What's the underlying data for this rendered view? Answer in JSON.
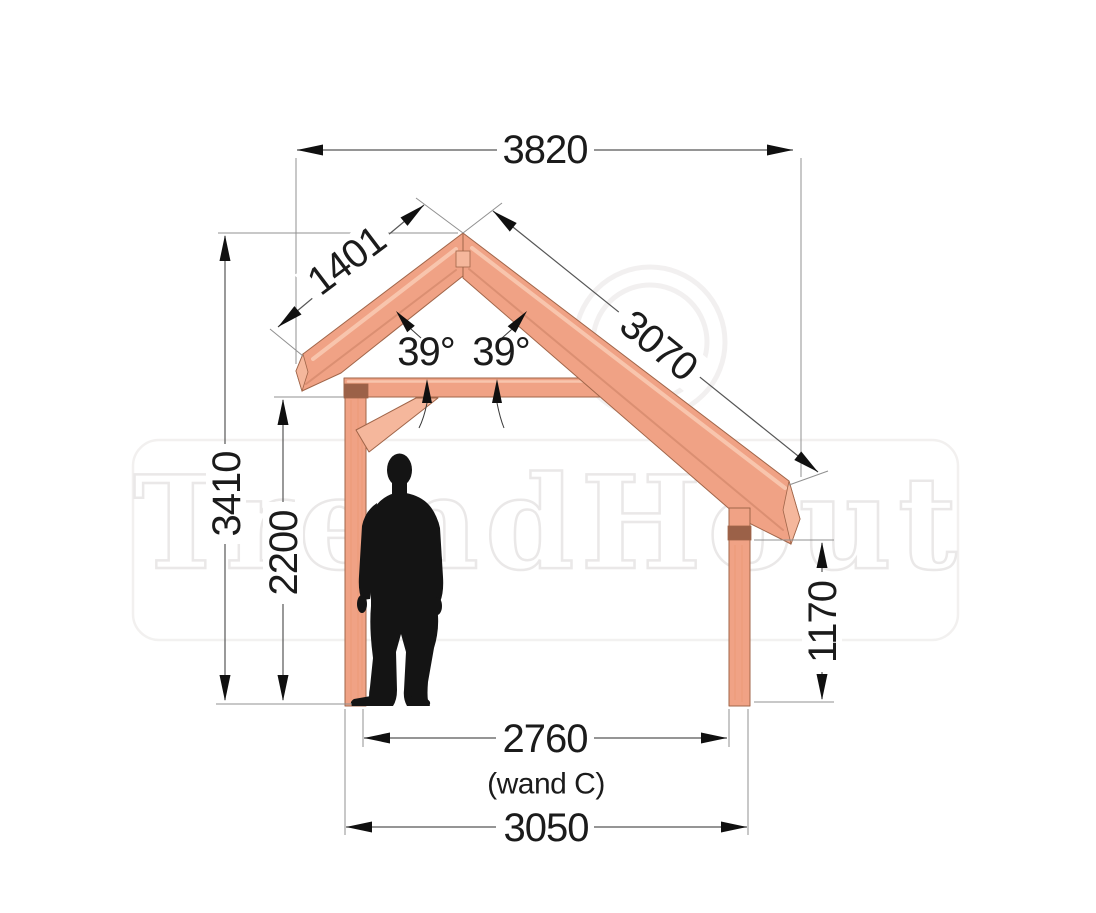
{
  "watermark": {
    "brand": "TrendHout"
  },
  "dimensions": {
    "roof_span": "3820",
    "rafter_left": "1401",
    "rafter_right": "3070",
    "roof_angle_left": "39°",
    "roof_angle_right": "39°",
    "ridge_height": "3410",
    "wall_height_left": "2200",
    "wall_height_right": "1170",
    "inner_width": "2760",
    "inner_width_label": "(wand C)",
    "outer_width": "3050"
  },
  "colors": {
    "wood": "#f0a285",
    "wood_light": "#f8c5ad",
    "wood_shadow": "#db8f72",
    "wood_outline": "#a06549",
    "wood_endgrain": "#f5b79c",
    "connector_block": "#9b6148",
    "silhouette": "#141414",
    "dimension_line": "#565656",
    "dimension_text": "#1b1b1b",
    "watermark_gray": "#e7e5e4"
  }
}
